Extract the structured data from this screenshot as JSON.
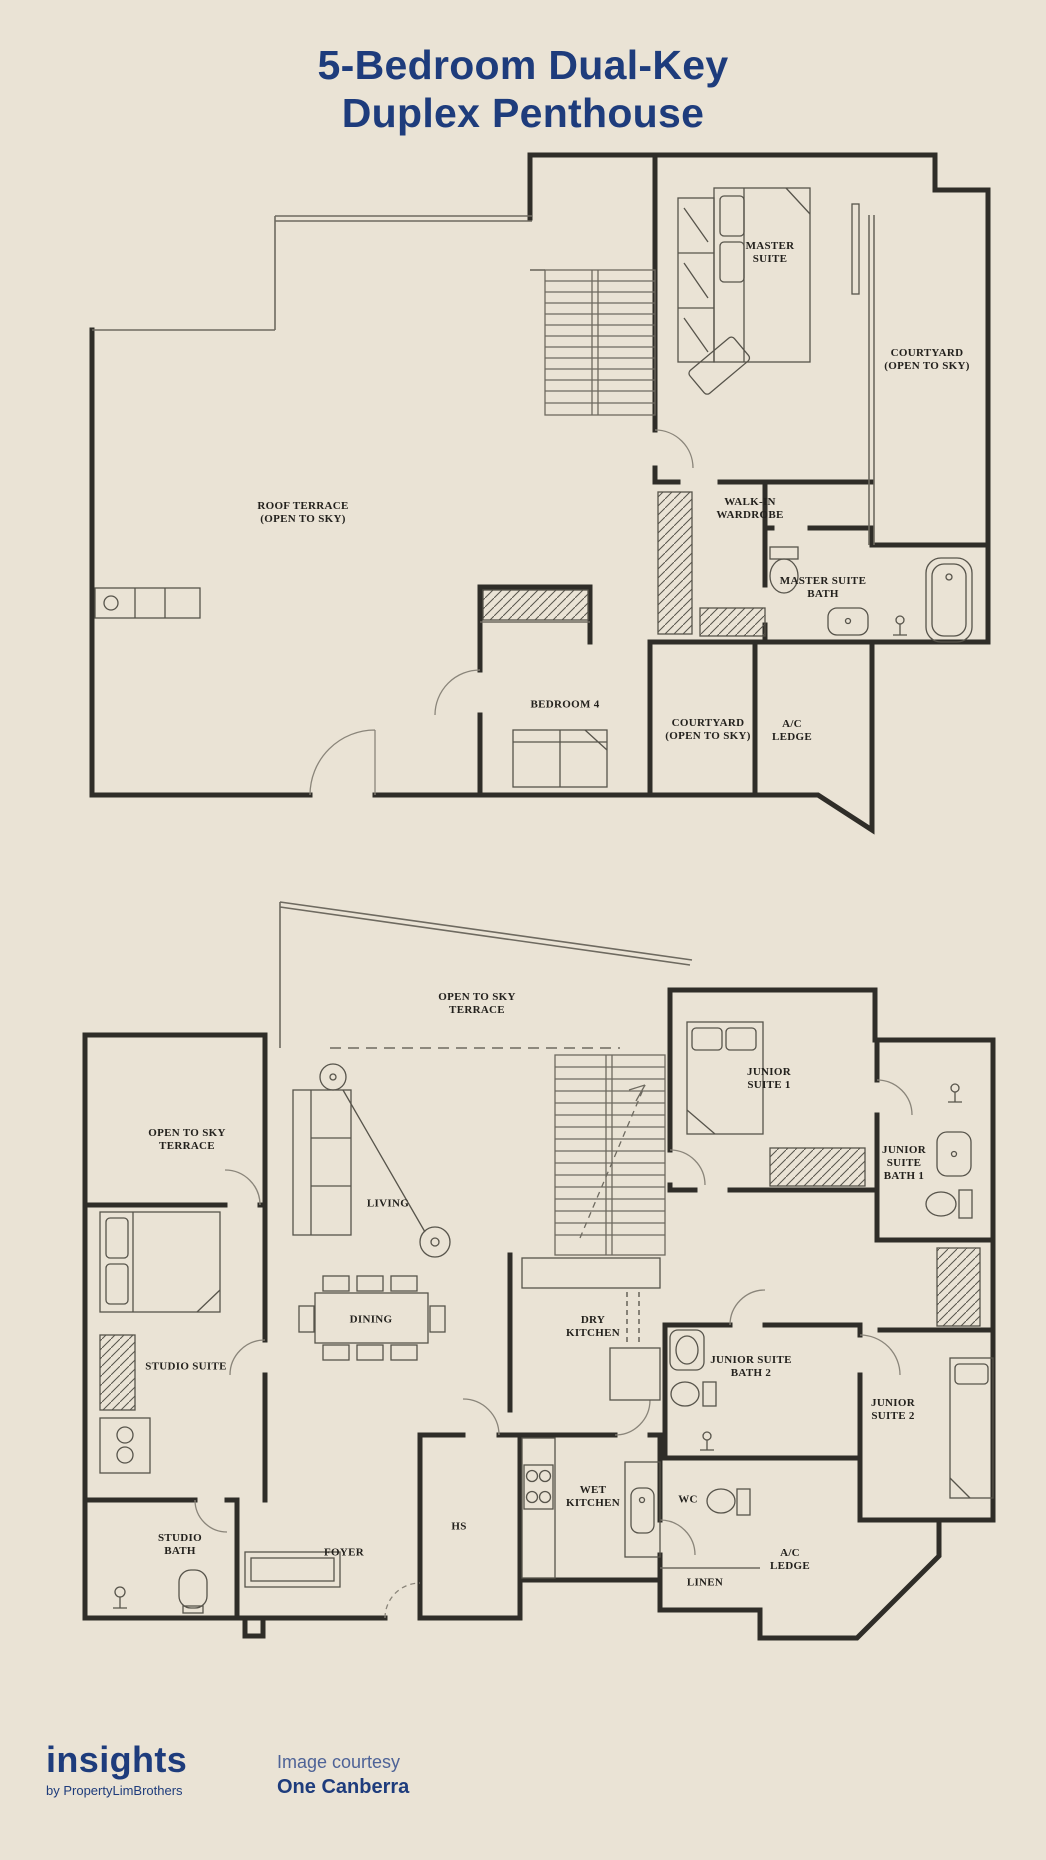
{
  "title": {
    "line1": "5-Bedroom Dual-Key",
    "line2": "Duplex Penthouse"
  },
  "upper_rooms": [
    {
      "label": "MASTER\nSUITE"
    },
    {
      "label": "COURTYARD\n(OPEN TO SKY)"
    },
    {
      "label": "ROOF TERRACE\n(OPEN TO SKY)"
    },
    {
      "label": "WALK-IN\nWARDROBE"
    },
    {
      "label": "MASTER SUITE\nBATH"
    },
    {
      "label": "BEDROOM 4"
    },
    {
      "label": "COURTYARD\n(OPEN TO SKY)"
    },
    {
      "label": "A/C\nLEDGE"
    }
  ],
  "lower_rooms": [
    {
      "label": "OPEN TO SKY\nTERRACE"
    },
    {
      "label": "JUNIOR\nSUITE 1"
    },
    {
      "label": "OPEN TO SKY\nTERRACE"
    },
    {
      "label": "JUNIOR\nSUITE\nBATH 1"
    },
    {
      "label": "LIVING"
    },
    {
      "label": "DINING"
    },
    {
      "label": "STUDIO SUITE"
    },
    {
      "label": "DRY\nKITCHEN"
    },
    {
      "label": "JUNIOR SUITE\nBATH 2"
    },
    {
      "label": "JUNIOR\nSUITE 2"
    },
    {
      "label": "WET\nKITCHEN"
    },
    {
      "label": "WC"
    },
    {
      "label": "HS"
    },
    {
      "label": "STUDIO\nBATH"
    },
    {
      "label": "FOYER"
    },
    {
      "label": "LINEN"
    },
    {
      "label": "A/C\nLEDGE"
    }
  ],
  "footer": {
    "brand": "insights",
    "brand_sub": "by PropertyLimBrothers",
    "credit_line1": "Image courtesy",
    "credit_line2": "One Canberra"
  },
  "colors": {
    "background": "#eae3d5",
    "title_navy": "#1e3c7c",
    "credit_blue": "#4e6397",
    "wall_dark": "#2f2d28"
  }
}
